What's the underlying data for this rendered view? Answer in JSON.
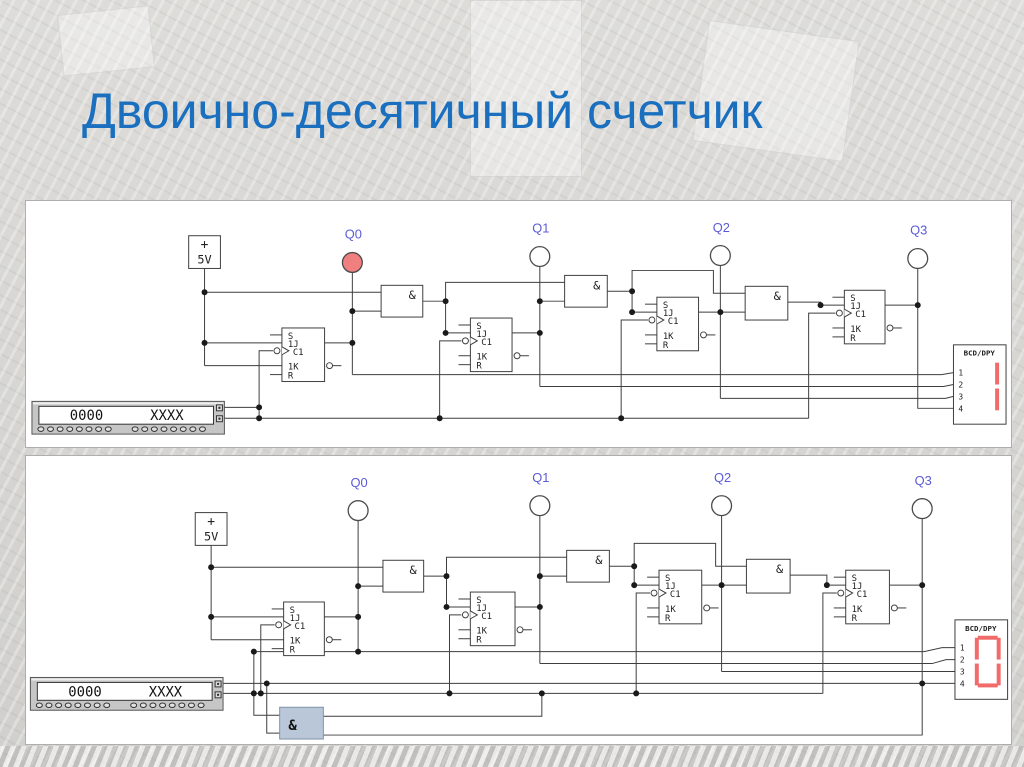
{
  "slide": {
    "title": "Двоично-десятичный счетчик"
  },
  "colors": {
    "title_blue": "#1a6fbe",
    "probe_label_blue": "#5b5bd8",
    "indicator_on_red": "#f08080",
    "indicator_off_white": "#ffffff",
    "segment_red": "#f26b6b",
    "selected_gate_blue": "#b9c7d9",
    "wire_gray": "#3e3e3e",
    "panel_white": "#ffffff",
    "background_gray": "#d6d5d2"
  },
  "component_labels": {
    "power_source_plus": "+",
    "power_source_voltage": "5V",
    "and_gate": "&",
    "flipflop_pins": [
      "S",
      "1J",
      "C1",
      "1K",
      "R"
    ],
    "bcd_display_title": "BCD/DPY",
    "bcd_display_pins": [
      "1",
      "2",
      "3",
      "4"
    ]
  },
  "panels": [
    {
      "name": "bcd-counter-running",
      "word_generator": {
        "address_value": "0000",
        "data_value": "XXXX"
      },
      "probes": [
        {
          "label": "Q0",
          "lit": true
        },
        {
          "label": "Q1",
          "lit": false
        },
        {
          "label": "Q2",
          "lit": false
        },
        {
          "label": "Q3",
          "lit": false
        }
      ],
      "display_digit": "1",
      "has_reset_gate": false
    },
    {
      "name": "bcd-counter-schematic",
      "word_generator": {
        "address_value": "0000",
        "data_value": "XXXX"
      },
      "probes": [
        {
          "label": "Q0",
          "lit": false
        },
        {
          "label": "Q1",
          "lit": false
        },
        {
          "label": "Q2",
          "lit": false
        },
        {
          "label": "Q3",
          "lit": false
        }
      ],
      "display_digit": "0",
      "has_reset_gate": true
    }
  ]
}
